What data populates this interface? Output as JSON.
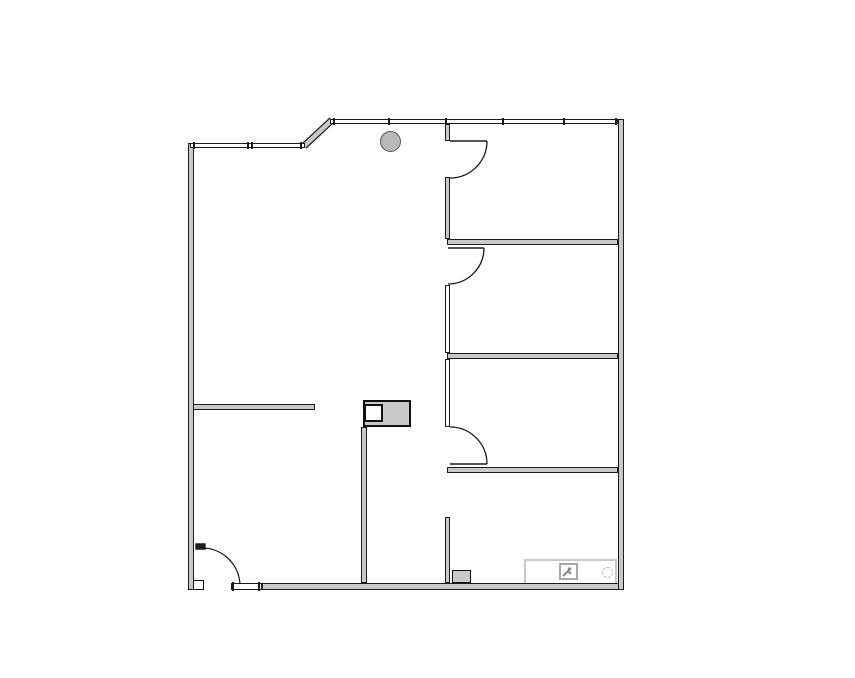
{
  "document": {
    "type": "architectural-floor-plan",
    "visible_text": "none",
    "description": "Black-and-gray line drawing of an office floor plan: one large open room on the left, three rooms plus a lower room along the right side separated by a corridor wall with swing doors, window walls along the top, an entry door at the bottom-left, a round structural column near the top, and a small image-placeholder watermark at the bottom-right."
  },
  "colors": {
    "background": "#ffffff",
    "wall_fill": "#c9c9c9",
    "wall_stroke": "#1c1c1c",
    "window_fill": "#ffffff",
    "column_fill": "#b9b9b9",
    "column_stroke": "#555555",
    "fixture_stroke": "#111111",
    "watermark_border": "#c8c8c8",
    "watermark_icon": "#999999"
  },
  "plan": {
    "canvas": {
      "width": 855,
      "height": 678
    },
    "solid_walls": [
      {
        "name": "exterior-wall-left",
        "x": 188,
        "y": 143,
        "w": 6,
        "h": 447
      },
      {
        "name": "exterior-wall-bottom",
        "x": 262,
        "y": 583,
        "w": 362,
        "h": 7
      },
      {
        "name": "exterior-wall-right",
        "x": 618,
        "y": 119,
        "w": 6,
        "h": 471
      },
      {
        "name": "partition-wall-room1-room2",
        "x": 447,
        "y": 239,
        "w": 171,
        "h": 6
      },
      {
        "name": "partition-wall-room2-room3",
        "x": 447,
        "y": 353,
        "w": 171,
        "h": 6
      },
      {
        "name": "partition-wall-room3-room4",
        "x": 447,
        "y": 467,
        "w": 171,
        "h": 6
      },
      {
        "name": "corridor-wall-stub-top",
        "x": 445,
        "y": 124,
        "w": 5,
        "h": 17
      },
      {
        "name": "corridor-wall-upper",
        "x": 445,
        "y": 177,
        "w": 5,
        "h": 62
      },
      {
        "name": "corridor-wall-stub-bottom",
        "x": 445,
        "y": 517,
        "w": 5,
        "h": 66
      },
      {
        "name": "interior-wall-left-room",
        "x": 193,
        "y": 404,
        "w": 122,
        "h": 6
      },
      {
        "name": "interior-wall-center-vertical",
        "x": 361,
        "y": 427,
        "w": 6,
        "h": 156
      }
    ],
    "thin_walls": [
      {
        "name": "corridor-wall-mid-upper",
        "x": 445,
        "y": 285,
        "w": 5,
        "h": 68
      },
      {
        "name": "corridor-wall-mid-lower",
        "x": 445,
        "y": 359,
        "w": 5,
        "h": 68
      }
    ],
    "window_walls": [
      {
        "name": "window-wall-top",
        "x": 330,
        "y": 119,
        "w": 288,
        "h": 5,
        "ticks": [
          333,
          388,
          445,
          502,
          563,
          615
        ]
      },
      {
        "name": "window-wall-top-left",
        "x": 190,
        "y": 143,
        "w": 115,
        "h": 5,
        "ticks": [
          193,
          247,
          251,
          300
        ]
      },
      {
        "name": "window-bottom-sidelite",
        "x": 231,
        "y": 583,
        "w": 31,
        "h": 7,
        "ticks": [
          232,
          258
        ]
      }
    ],
    "diagonal_wall": {
      "name": "window-wall-diagonal",
      "x1": 304,
      "y1": 146,
      "x2": 332,
      "y2": 120,
      "outer": 7,
      "inner": 4.6
    },
    "doors": [
      {
        "name": "door-room1",
        "leaf": "M450,141 H487",
        "swing": "M487,141 A37,37 0 0 1 450,178",
        "leaf_filled": false
      },
      {
        "name": "door-room2",
        "leaf": "M448,248 H484",
        "swing": "M484,248 A36,36 0 0 1 448,284",
        "leaf_filled": false
      },
      {
        "name": "door-room3",
        "leaf": "M450,464 H487",
        "swing": "M450,427 A37,37 0 0 1 487,464",
        "leaf_filled": false
      },
      {
        "name": "door-entry",
        "leaf": "M196,544 h9 v5 h-9 Z",
        "swing": "M202,548 A38,38 0 0 1 240,586",
        "leaf_filled": true
      }
    ],
    "column": {
      "name": "structural-column",
      "cx": 390,
      "cy": 141,
      "r": 10.5
    },
    "fixtures": [
      {
        "name": "equipment-box-outer",
        "x": 363,
        "y": 400,
        "w": 48,
        "h": 27,
        "fill": "wall_fill",
        "stroke": "#111111",
        "sw": 2
      },
      {
        "name": "equipment-box-inner",
        "x": 364,
        "y": 404,
        "w": 19,
        "h": 18,
        "fill": "#ffffff",
        "stroke": "#111111",
        "sw": 2
      },
      {
        "name": "door-jamb-post",
        "x": 193,
        "y": 580,
        "w": 11,
        "h": 10,
        "fill": "#ffffff",
        "stroke": "#111111",
        "sw": 1.5
      },
      {
        "name": "cabinet-fixture",
        "x": 452,
        "y": 570,
        "w": 19,
        "h": 13,
        "fill": "wall_fill",
        "stroke": "#111111",
        "sw": 1.5
      }
    ],
    "watermark": {
      "name": "watermark-placeholder",
      "x": 524,
      "y": 559,
      "w": 93,
      "h": 26
    }
  }
}
